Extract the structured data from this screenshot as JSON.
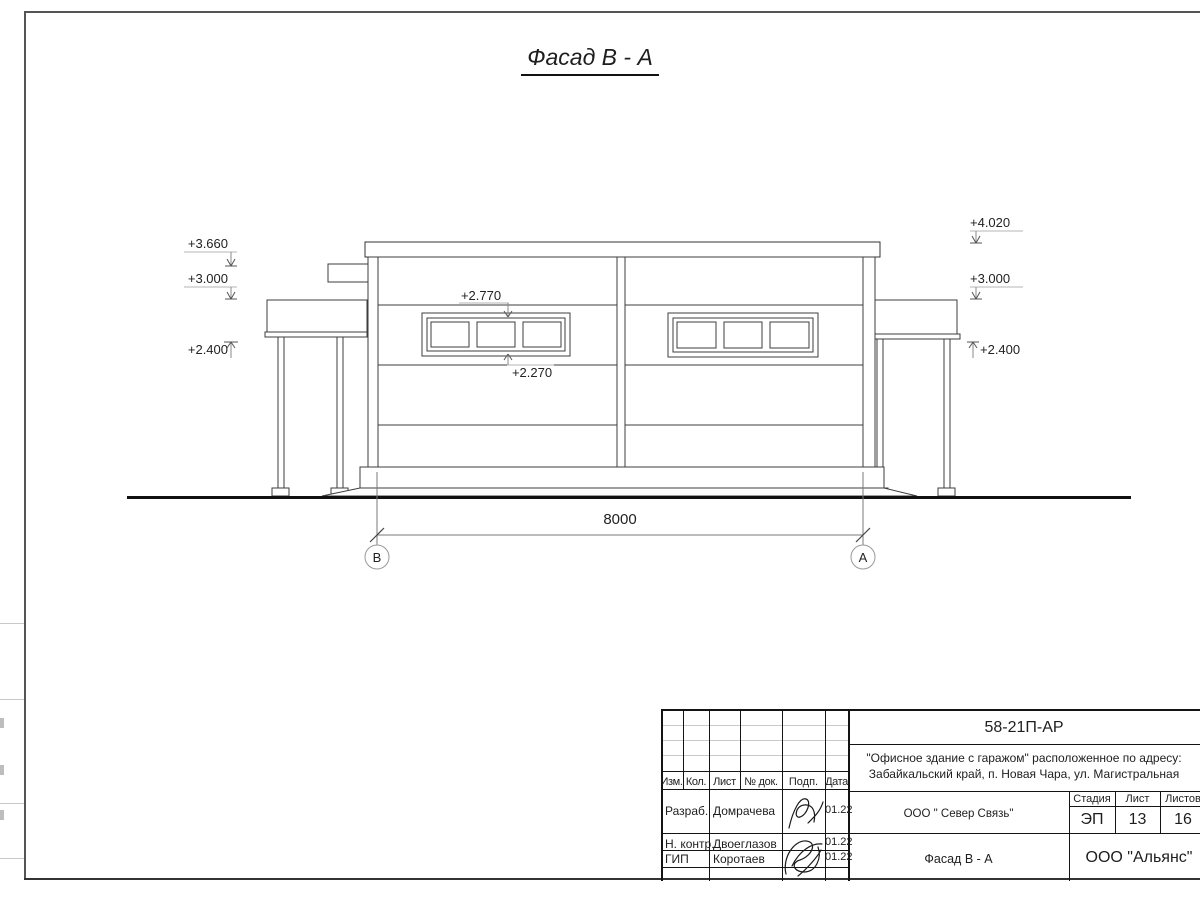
{
  "colors": {
    "paper": "#ffffff",
    "ink": "#1e1e1e",
    "drawing_line": "#3d3d3d",
    "faint_line": "#c9c9c9",
    "frame_line": "#555555"
  },
  "drawing_title": "Фасад В - А",
  "facade": {
    "marks_left": [
      "+3.660",
      "+3.000",
      "+2.400"
    ],
    "marks_right": [
      "+4.020",
      "+3.000",
      "+2.400"
    ],
    "window_mark_top": "+2.770",
    "window_mark_bottom": "+2.270",
    "dimension": "8000",
    "axis_left": "В",
    "axis_right": "А"
  },
  "title_block": {
    "code": "58-21П-АР",
    "project_address_line1": "\"Офисное здание с гаражом\" расположенное по адресу:",
    "project_address_line2": "Забайкальский край, п. Новая Чара, ул. Магистральная",
    "client": "ООО \" Север Связь\"",
    "drawing_name": "Фасад В - А",
    "company": "ООО \"Альянс\"",
    "stage_label": "Стадия",
    "sheet_label": "Лист",
    "sheets_label": "Листов",
    "stage_value": "ЭП",
    "sheet_value": "13",
    "sheets_value": "16",
    "columns": [
      "Изм.",
      "Кол.",
      "Лист",
      "№ док.",
      "Подп.",
      "Дата"
    ],
    "rows": [
      {
        "role": "Разраб.",
        "name": "Домрачева",
        "date": "01.22"
      },
      {
        "role": "Н. контр.",
        "name": "Двоеглазов",
        "date": "01.22"
      },
      {
        "role": "ГИП",
        "name": "Коротаев",
        "date": "01.22"
      }
    ]
  }
}
